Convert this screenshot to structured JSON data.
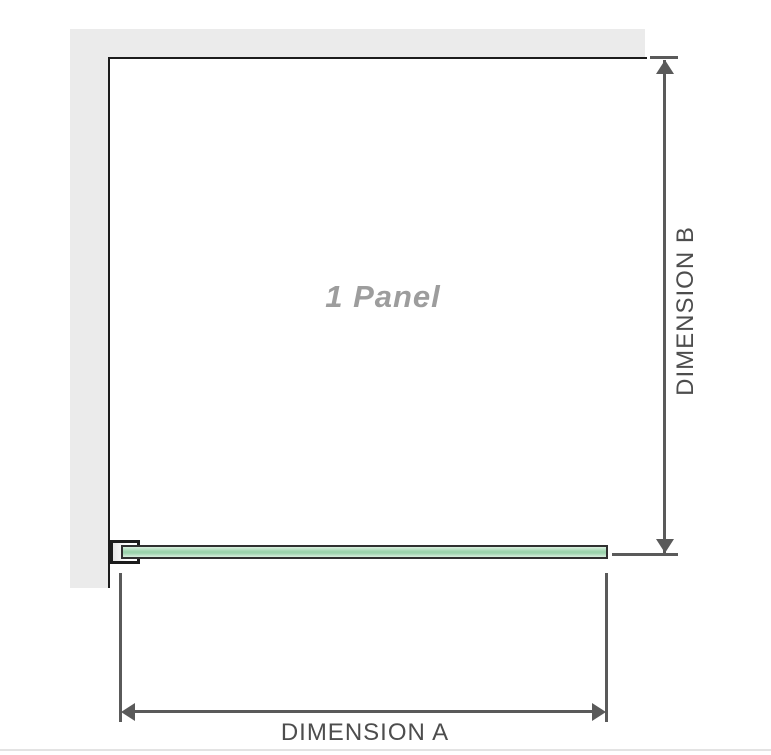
{
  "diagram": {
    "title": "1 Panel",
    "dimensions": {
      "horizontal": {
        "label": "DIMENSION A"
      },
      "vertical": {
        "label": "DIMENSION B"
      }
    }
  },
  "colors": {
    "background": "#ffffff",
    "wall_fill": "#ebebeb",
    "wall_edge": "#1c1c1c",
    "dimension_line": "#5a5a5a",
    "dimension_text": "#4d4d4d",
    "panel_text": "#9d9d9d",
    "glass_border": "#303030",
    "glass_light": "#d9efde",
    "glass_mid": "#9bd3ac",
    "divider": "#e3e3e3"
  }
}
